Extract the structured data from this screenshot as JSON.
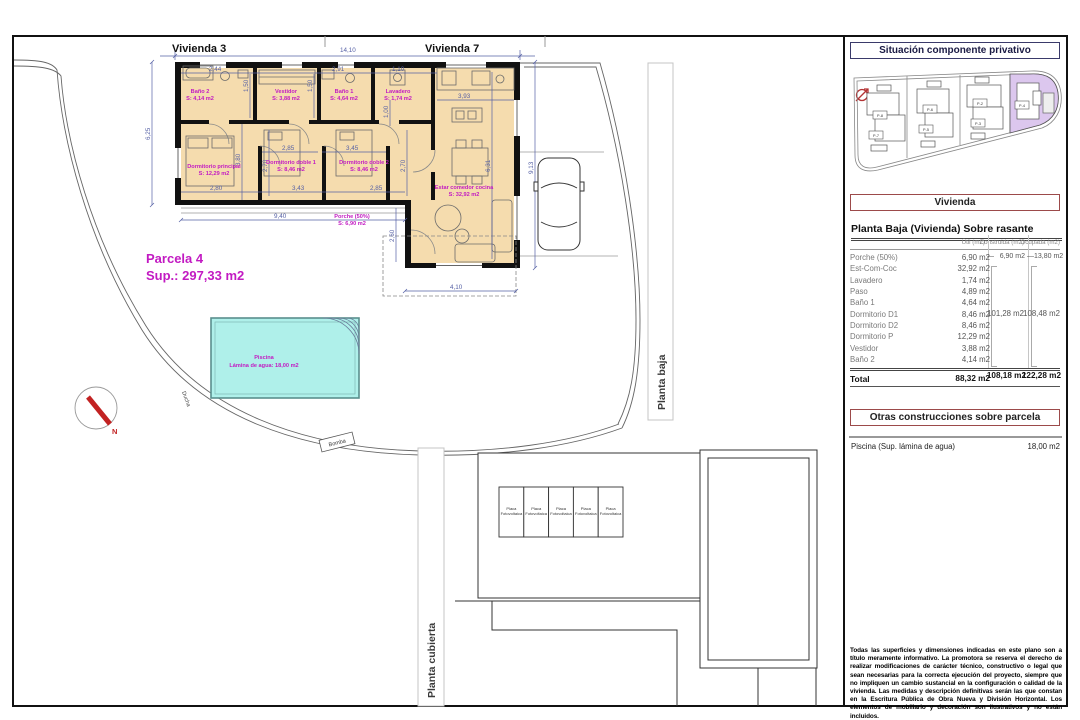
{
  "plan": {
    "vivienda3": "Vivienda 3",
    "vivienda7": "Vivienda 7",
    "parcela_title": "Parcela 4",
    "parcela_sup": "Sup.: 297,33 m2",
    "rooms": [
      {
        "name": "Baño 2",
        "area": "S: 4,14 m2"
      },
      {
        "name": "Vestidor",
        "area": "S: 3,88 m2"
      },
      {
        "name": "Baño 1",
        "area": "S: 4,64 m2"
      },
      {
        "name": "Lavadero",
        "area": "S: 1,74 m2"
      },
      {
        "name": "Dormitorio principal",
        "area": "S: 12,29 m2"
      },
      {
        "name": "Dormitorio doble 1",
        "area": "S: 8,46 m2"
      },
      {
        "name": "Dormitorio doble 2",
        "area": "S: 8,46 m2"
      },
      {
        "name": "Estar comedor cocina",
        "area": "S: 32,92 m2"
      },
      {
        "name": "Porche (50%)",
        "area": "S: 6,90 m2"
      }
    ],
    "pool_name": "Piscina",
    "pool_area": "Lámina de agua: 18,00 m2",
    "ducha": "Ducha",
    "bomba": "Bomba",
    "north": "N",
    "planta_baja": "Planta baja",
    "planta_cubierta": "Planta cubierta",
    "placa_line1": "Placa",
    "placa_line2": "Fotovoltaica",
    "dims": [
      "14,10",
      "2,44",
      "2,91",
      "1,10",
      "3,93",
      "1,50",
      "1,50",
      "1,00",
      "6,25",
      "3,80",
      "2,85",
      "3,45",
      "2,70",
      "2,70",
      "6,31",
      "9,13",
      "2,80",
      "3,43",
      "2,85",
      "9,40",
      "2,60",
      "4,10"
    ]
  },
  "inset": {
    "plots": [
      "P-8",
      "P-7",
      "P-6",
      "P-5",
      "P-2",
      "P-3",
      "P-4"
    ]
  },
  "panel": {
    "situacion_title": "Situación componente privativo",
    "vivienda_title": "Vivienda",
    "table": {
      "title": "Planta Baja (Vivienda) Sobre rasante",
      "col_util": "Útil (m2)",
      "col_construida": "Construida (m2)",
      "col_ocupada": "Ocupada (m2)",
      "rows": [
        {
          "label": "Porche (50%)",
          "util": "6,90 m2"
        },
        {
          "label": "Est-Com-Coc",
          "util": "32,92 m2"
        },
        {
          "label": "Lavadero",
          "util": "1,74 m2"
        },
        {
          "label": "Paso",
          "util": "4,89 m2"
        },
        {
          "label": "Baño 1",
          "util": "4,64 m2"
        },
        {
          "label": "Dormitorio D1",
          "util": "8,46 m2"
        },
        {
          "label": "Dormitorio D2",
          "util": "8,46 m2"
        },
        {
          "label": "Dormitorio P",
          "util": "12,29 m2"
        },
        {
          "label": "Vestidor",
          "util": "3,88 m2"
        },
        {
          "label": "Baño 2",
          "util": "4,14 m2"
        }
      ],
      "dash": "—",
      "porche_construida": "6,90 m2",
      "porche_ocupada": "13,80 m2",
      "group_construida": "101,28 m2",
      "group_ocupada": "108,48 m2",
      "total_label": "Total",
      "total_util": "88,32 m2",
      "total_construida": "108,18 m2",
      "total_ocupada": "122,28 m2"
    },
    "otras_title": "Otras construcciones sobre parcela",
    "piscina_label": "Piscina (Sup. lámina de agua)",
    "piscina_value": "18,00 m2",
    "disclaimer": "Todas las superficies y dimensiones indicadas en este plano son a título meramente informativo. La promotora se reserva el derecho de realizar modificaciones de carácter técnico, constructivo o legal que sean necesarias para la correcta ejecución del proyecto, siempre que no impliquen un cambio sustancial en la configuración o calidad de la vivienda. Las medidas y descripción definitivas serán las que constan en la Escritura Pública de Obra Nueva y División Horizontal. Los elementos de mobiliario y decoración son ilustrativos y no están incluidos."
  },
  "colors": {
    "floor_tan": "#f5dcae",
    "pool_cyan": "#aff0ea",
    "magenta": "#c21ac2",
    "dim_blue": "#5560a5",
    "highlight_purple": "#dcc7ee",
    "north_red": "#c22222"
  }
}
